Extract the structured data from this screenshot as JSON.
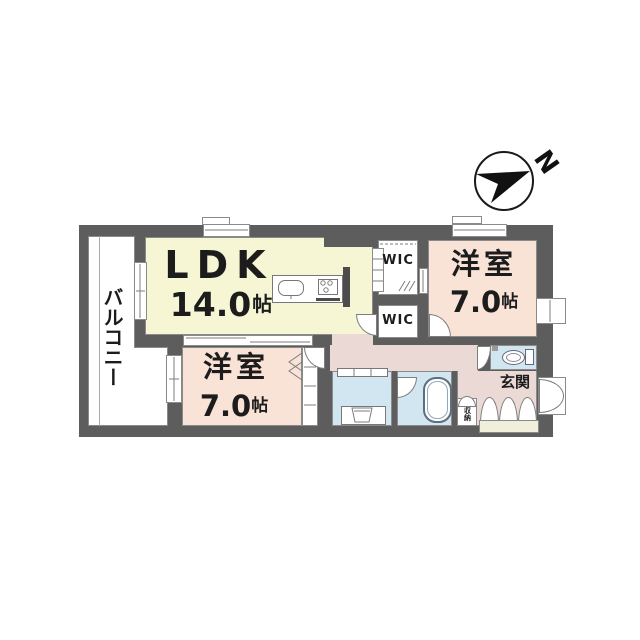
{
  "compass": {
    "north_label": "N"
  },
  "rooms": {
    "balcony": {
      "label": "バルコニー"
    },
    "ldk": {
      "label": "LDK",
      "size": "14.0",
      "size_unit": "帖"
    },
    "bedroom_top": {
      "label": "洋室",
      "size": "7.0",
      "size_unit": "帖"
    },
    "bedroom_bottom": {
      "label": "洋室",
      "size": "7.0",
      "size_unit": "帖"
    },
    "wic_top": {
      "label": "WIC"
    },
    "wic_bottom": {
      "label": "WIC"
    },
    "entrance": {
      "label": "玄関"
    },
    "storage": {
      "label": "収納"
    }
  },
  "colors": {
    "wall": "#5d5d5d",
    "ldk_fill": "#f6f6d4",
    "bedroom_fill": "#f9e3d7",
    "hall_fill": "#ead9d5",
    "wet_fill": "#d2e6f2",
    "cabinet_fill": "#f1eedb",
    "balcony_fill": "#ffffff"
  }
}
